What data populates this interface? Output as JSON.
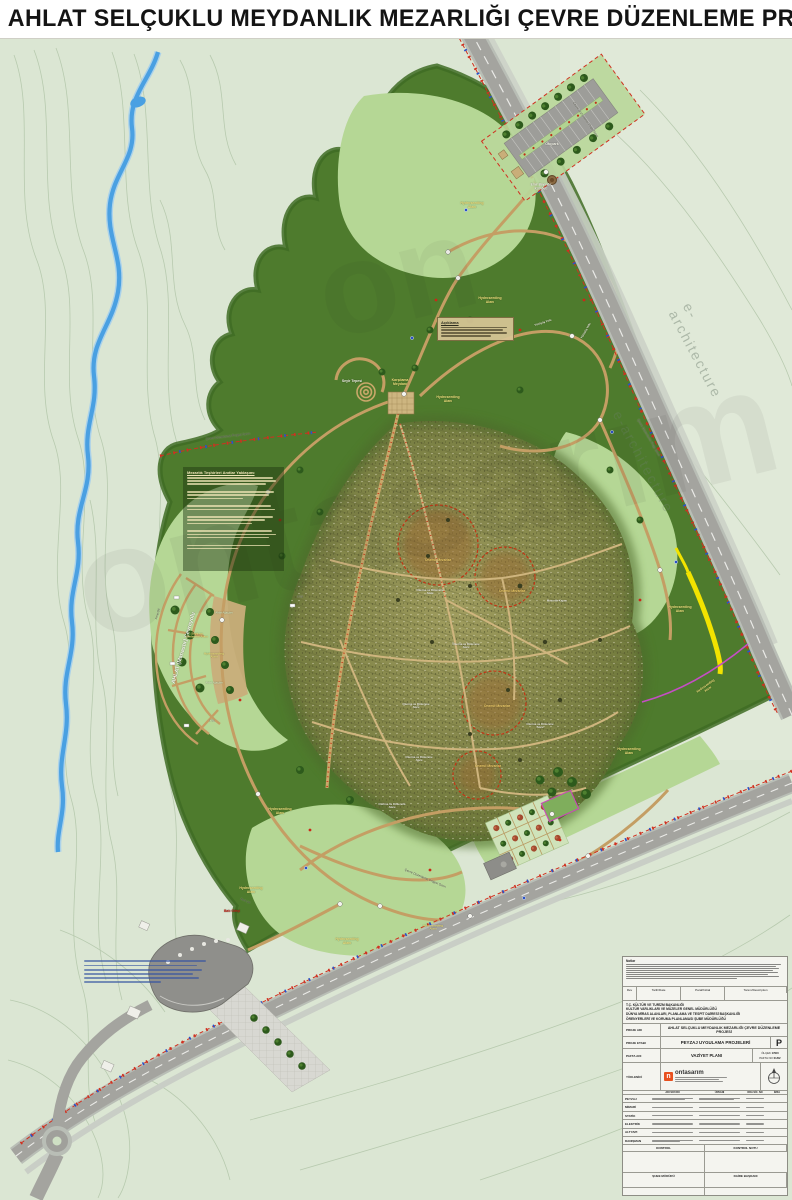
{
  "title": "AHLAT SELÇUKLU MEYDANLIK MEZARLIĞI ÇEVRE DÜZENLEME PROJESİ",
  "watermark": {
    "brand": "ontasarım",
    "tagline": "e-architecture"
  },
  "site_notes": {
    "heading": "Mezarlık Teşhirleri Anıtlar Yaklaşımı"
  },
  "aciklama": {
    "heading": "Açıklama"
  },
  "map_labels": [
    {
      "name": "boundary-label-parking",
      "text": "Çevre Düzenleme Proje Sınırı",
      "x": 585,
      "y": 120,
      "size": 3.2,
      "color": "#55554a",
      "rot": 55,
      "dk": true
    },
    {
      "name": "otopark-label",
      "text": "Otopark",
      "x": 552,
      "y": 144,
      "size": 3.5,
      "color": "#f6f6ea"
    },
    {
      "name": "kumbet-label",
      "text": "Emir Bayındır\nKümbeti",
      "x": 541,
      "y": 187,
      "size": 3.2,
      "color": "#f6f6ea"
    },
    {
      "name": "hydroseeding-1",
      "text": "Hydroseeding\nAlanı",
      "x": 472,
      "y": 205,
      "size": 3.5,
      "color": "#efe27d"
    },
    {
      "name": "hydroseeding-2",
      "text": "Hydroseeding\nAlanı",
      "x": 490,
      "y": 300,
      "size": 3.5,
      "color": "#efe27d"
    },
    {
      "name": "seyir-tepesi-label",
      "text": "Seyir Tepesi",
      "x": 352,
      "y": 381,
      "size": 3.5,
      "color": "#f6f6ea"
    },
    {
      "name": "karsilama-meydani-label",
      "text": "Karşılama\nMeydanı",
      "x": 400,
      "y": 382,
      "size": 3.5,
      "color": "#efe27d"
    },
    {
      "name": "hydroseeding-3",
      "text": "Hydroseeding\nAlanı",
      "x": 448,
      "y": 399,
      "size": 3.5,
      "color": "#efe27d"
    },
    {
      "name": "boundary-label-west",
      "text": "Çevre Düzenleme Projesi Sınırı",
      "x": 228,
      "y": 437,
      "size": 3.2,
      "color": "#46463c",
      "rot": -7,
      "dk": true
    },
    {
      "name": "yuruyus-yolu-1",
      "text": "Yürüyüş Yolu",
      "x": 543,
      "y": 323,
      "size": 2.8,
      "color": "#f0f0e0",
      "rot": -18
    },
    {
      "name": "yuruyus-yolu-2",
      "text": "Yürüyüş Yolu",
      "x": 586,
      "y": 331,
      "size": 2.8,
      "color": "#f0f0e0",
      "rot": -60
    },
    {
      "name": "cevreyolu-label",
      "text": "AHLAT (Manastır) Çevreyolu",
      "x": 184,
      "y": 648,
      "size": 5.5,
      "color": "#f8f8f0",
      "rot": -74
    },
    {
      "name": "fens-citi-1",
      "text": "Fens Çiti",
      "x": 158,
      "y": 614,
      "size": 2.8,
      "color": "#3c3c34",
      "rot": -76,
      "dk": true
    },
    {
      "name": "seyir-dinlenme-label",
      "text": "Seyir ve\nDinlenme Alanı",
      "x": 197,
      "y": 636,
      "size": 3,
      "color": "#efe27d"
    },
    {
      "name": "hydroseeding-4",
      "text": "Hydroseeding\nAlanı",
      "x": 214,
      "y": 656,
      "size": 3,
      "color": "#efe27d"
    },
    {
      "name": "ahlat-agaclari-1",
      "text": "Ahlat Ağaçları",
      "x": 224,
      "y": 614,
      "size": 2.6,
      "color": "#dcecc0"
    },
    {
      "name": "ahlat-agaclari-2",
      "text": "Ahlat Ağaçları",
      "x": 214,
      "y": 684,
      "size": 2.6,
      "color": "#dcecc0"
    },
    {
      "name": "onemli-mezarlar-1",
      "text": "Önemli Mezarlar",
      "x": 438,
      "y": 561,
      "size": 3.4,
      "color": "#f2cf6a"
    },
    {
      "name": "onemli-mezarlar-2",
      "text": "Önemli Mezarlar",
      "x": 512,
      "y": 592,
      "size": 3.4,
      "color": "#f2cf6a"
    },
    {
      "name": "onemli-mezarlar-3",
      "text": "Önemli Mezarlar",
      "x": 497,
      "y": 707,
      "size": 3.4,
      "color": "#f2cf6a"
    },
    {
      "name": "onemli-mezarlar-4",
      "text": "Önemli Mezarlar",
      "x": 488,
      "y": 767,
      "size": 3.4,
      "color": "#f2cf6a"
    },
    {
      "name": "oturma-dinlenme-1",
      "text": "Oturma ve Dinlenme\nAlanı",
      "x": 430,
      "y": 592,
      "size": 2.8,
      "color": "#f0f0e4"
    },
    {
      "name": "oturma-dinlenme-2",
      "text": "Oturma ve Dinlenme\nAlanı",
      "x": 466,
      "y": 646,
      "size": 2.8,
      "color": "#f0f0e4"
    },
    {
      "name": "oturma-dinlenme-3",
      "text": "Oturma ve Dinlenme\nAlanı",
      "x": 416,
      "y": 706,
      "size": 2.8,
      "color": "#f0f0e4"
    },
    {
      "name": "oturma-dinlenme-4",
      "text": "Oturma ve Dinlenme\nAlanı",
      "x": 540,
      "y": 726,
      "size": 2.8,
      "color": "#f0f0e4"
    },
    {
      "name": "oturma-dinlenme-5",
      "text": "Oturma ve Dinlenme\nAlanı",
      "x": 419,
      "y": 759,
      "size": 2.8,
      "color": "#f0f0e4"
    },
    {
      "name": "oturma-dinlenme-6",
      "text": "Oturma ve Dinlenme\nAlanı",
      "x": 392,
      "y": 806,
      "size": 2.8,
      "color": "#f0f0e4"
    },
    {
      "name": "mezarlik-kapisi-label",
      "text": "Mezarlık Kapısı",
      "x": 557,
      "y": 601,
      "size": 2.8,
      "color": "#f0f0e4"
    },
    {
      "name": "hydroseeding-5",
      "text": "Hydroseeding\nAlanı",
      "x": 680,
      "y": 609,
      "size": 3.5,
      "color": "#efe27d"
    },
    {
      "name": "hydroseeding-6",
      "text": "Hydroseeding\nAlanı",
      "x": 707,
      "y": 688,
      "size": 3.2,
      "color": "#efe27d",
      "rot": -35
    },
    {
      "name": "hydroseeding-7",
      "text": "Hydroseeding\nAlanı",
      "x": 629,
      "y": 751,
      "size": 3.5,
      "color": "#efe27d"
    },
    {
      "name": "hydroseeding-8",
      "text": "Hydroseeding\nAlanı",
      "x": 280,
      "y": 811,
      "size": 3.5,
      "color": "#efe27d"
    },
    {
      "name": "hydroseeding-9",
      "text": "Hydroseeding\nAlanı",
      "x": 251,
      "y": 890,
      "size": 3.5,
      "color": "#efe27d"
    },
    {
      "name": "hydroseeding-10",
      "text": "Hydroseeding\nAlanı",
      "x": 347,
      "y": 941,
      "size": 3.5,
      "color": "#efe27d"
    },
    {
      "name": "hydroseeding-11",
      "text": "Hydroseeding\nAlanı",
      "x": 433,
      "y": 928,
      "size": 3,
      "color": "#efe27d"
    },
    {
      "name": "bati-girisi-label",
      "text": "Batı Girişi",
      "x": 232,
      "y": 912,
      "size": 3.4,
      "color": "#c22418"
    },
    {
      "name": "fens-citi-2",
      "text": "Fens Çiti",
      "x": 245,
      "y": 902,
      "size": 2.6,
      "color": "#3c3c34",
      "rot": 22,
      "dk": true
    },
    {
      "name": "boundary-label-south",
      "text": "Çevre Düzenleme Projesi Sınırı",
      "x": 425,
      "y": 879,
      "size": 3.2,
      "color": "#46463c",
      "rot": 23,
      "dk": true
    },
    {
      "name": "boundary-label-east",
      "text": "Çevre Düzenleme Proje Sınırı",
      "x": 648,
      "y": 438,
      "size": 3.2,
      "color": "#55554a",
      "rot": 60,
      "dk": true
    },
    {
      "name": "contour-1710",
      "text": "1710",
      "x": 300,
      "y": 598,
      "size": 2.6,
      "color": "#666660",
      "dk": true
    },
    {
      "name": "contour-1716",
      "text": "1716",
      "x": 212,
      "y": 722,
      "size": 2.6,
      "color": "#666660",
      "dk": true
    }
  ],
  "title_block": {
    "notes_heading": "Notlar",
    "revision_headers": [
      "Rev",
      "Tarih/Date",
      "Paraf/Initial",
      "Tanım/Description"
    ],
    "ministry": [
      "T.C. KÜLTÜR VE TURİZM BAKANLIĞI",
      "KÜLTÜR VARLIKLARI VE MÜZELER GENEL MÜDÜRLÜĞÜ",
      "DÜNYA MİRAS ALANLARI, PLANLAMA VE TESPİT DAİRESİ BAŞKANLIĞI",
      "ÖRENYERLERİ VE KORUMA PLANLAMASI ŞUBE MÜDÜRLÜĞÜ"
    ],
    "rows": {
      "proje_adi_label": "PROJE ADI",
      "proje_adi": "AHLAT SELÇUKLU MEYDANLIK MEZARLIĞI ÇEVRE DÜZENLEME PROJESİ",
      "proje_etabi_label": "PROJE ETABI",
      "proje_etabi": "PEYZAJ UYGULAMA PROJELERİ",
      "etap_kodu": "P",
      "pafta_adi_label": "PAFTA ADI",
      "pafta_adi": "VAZİYET PLANI",
      "olcek_label": "ÖLÇEK",
      "olcek": "1/500",
      "pafta_no_label": "PAFTA NO",
      "pafta_no": "01/02",
      "yuklenici_label": "YÜKLENİCİ",
      "yuklenici": "ontasarım"
    },
    "staff_headers": [
      "ADI SOYADI",
      "ÜNVANI",
      "ODA SİC. NO",
      "İMZA"
    ],
    "staff_rows": [
      "PEYZAJ",
      "MİMARİ",
      "STATİK",
      "ELEKTRİK",
      "ALTYAPI",
      "DANIŞMAN"
    ],
    "footer": {
      "kontrol": "KONTROL",
      "kontrol_notu": "KONTROL NOTU",
      "sube_muduru": "ŞUBE MÜDÜRÜ",
      "daire_baskani": "DAİRE BAŞKANI"
    }
  }
}
